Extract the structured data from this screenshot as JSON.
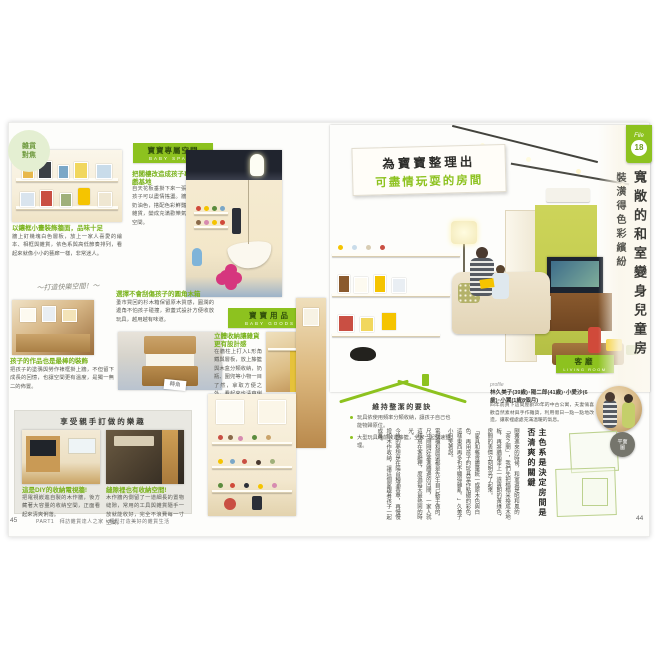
{
  "left_page": {
    "badge": {
      "line1": "雜貨",
      "line2": "對焦"
    },
    "photo1_caption": {
      "title": "以鑲框小畫裝飾牆面，品味十足",
      "body": "牆上釘幾塊白色層板，放上一家人喜愛的繪本、相框與雜貨，依色系與高低節奏排列，看起來就像小小的藝廊一樣，非常迷人。"
    },
    "baby_space": {
      "title": "寶寶專屬空間",
      "subtitle": "BABY SPACE",
      "heading": "把閣樓改造成孩子專屬的遊戲基地",
      "body": "自天花板垂掛下來一張小吊床，孩子可以盡情搖盪。牆面漆成了奶油色，搭配色彩鮮豔的玩具與雜貨，變成充滿歡樂氣氛的遊戲空間。"
    },
    "note": "～打造快樂空間！～",
    "photo2_caption": {
      "title": "孩子的作品也是最棒的裝飾",
      "body": "把孩子的塗鴉與勞作裱框掛上牆，不但留下成長的回憶，也讓空間更有溫度，是獨一無二的佈置。"
    },
    "chest": {
      "heading": "選擇不會刮傷孩子的圓角木箱",
      "body": "蚤市買回的杉木箱保留原木質感，圓潤的邊角不怕孩子碰撞，掀蓋式設計方便收放玩具，越用越有味道。",
      "tag": "轉角"
    },
    "baby_goods": {
      "title": "寶寶用品",
      "subtitle": "BABY GOODS",
      "heading": "立體收納讓雜貨更有設計感",
      "body": "在牆柱上打入L形角鐵與層板，放上籐籃與木盒分類收納，奶瓶、圍兜等小物一目了然，拿取方便之外，看起來也清爽俐落。"
    },
    "diy": {
      "title": "享受親手訂做的樂趣",
      "left": {
        "caption": "這是DIY的收納電視牆!",
        "body": "把電視嵌進自製的木作牆，後方藏著大容量的收納空間，正面看起來清爽俐落。"
      },
      "right": {
        "caption": "縫隙裡也有收納空間!",
        "body": "木作牆內側留了一道細長的置物縫隙，常用的工具與雜貨隨手一放就能收好，完全不浪費每一寸空間。"
      }
    },
    "folio": "45",
    "footer": "PART1　拜訪雜貨達人之家｜輕鬆打造美好的雜貨生活"
  },
  "right_page": {
    "file_badge": {
      "label": "File",
      "number": "18"
    },
    "headline": {
      "line1": "為寶寶整理出",
      "line2": "可盡情玩耍的房間"
    },
    "side_title": "寬敞的和室變身兒童房",
    "side_subtitle": "裝潢得色彩繽紛",
    "room_label": {
      "zh": "客廳",
      "en": "LIVING ROOM"
    },
    "tips": {
      "title": "維持整潔的要訣",
      "bullets": [
        "玩具依使用頻率分類收納，讓孩子自己也能物歸原位。",
        "大型玩具睡前收進籐籃，全家一起快速整理。"
      ]
    },
    "profile": {
      "label": "profile",
      "names": "林久美子(39歲)･陽二郎(41歲)･小愛沙(6歲)･小翼(1歲8個月)",
      "body": "四年前買下這間屋齡20年的中古公寓，夫妻倆喜歡自然素材與手作雜貨，利用假日一點一點地改造，讓家裡處處充滿溫暖的氣息。"
    },
    "article": {
      "heading": "主色系是決定房間是否清爽的關鍵",
      "paragraphs": [
        "剛搬進來的時候，和室還是昭和風的「茶之間」，我們先把榻榻米換成木地板，再將牆面漆上一道爽朗的黃綠色，房間的表情立刻明亮了起來。",
        "「家具和雜貨盡量統一成原木色與白色，再用孩子的玩具當作點綴的彩色，這樣東西再多也不顯得雜亂。」久美子小姐笑著說。",
        "電視櫃和層架都是先生自己動手做的，尺寸剛剛好塞進牆邊的凹間，一家人就這樣窩在客廳裡，度過每天最熱鬧的時光。",
        "今後的夢想是在陽台種滿香草，再慢慢增加木作收納，讓這個家跟著孩子一起成長。"
      ]
    },
    "plan_bubble": {
      "line1": "平面",
      "line2": "圖"
    },
    "folio": "44"
  }
}
